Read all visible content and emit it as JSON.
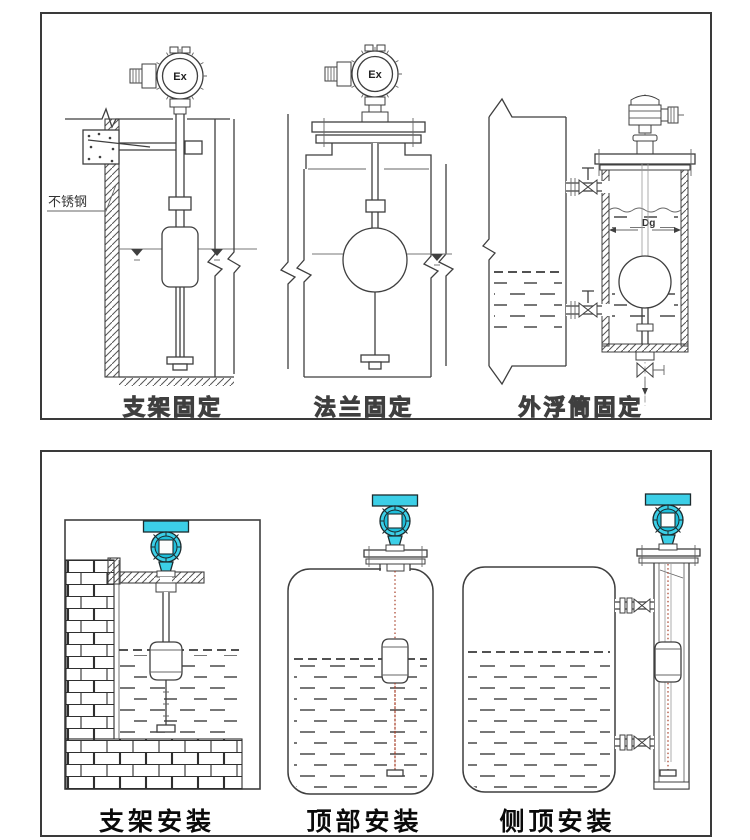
{
  "sheet": {
    "description_labels_visible_only": true
  },
  "panels": {
    "top": {
      "labels": [
        "支架固定",
        "法兰固定",
        "外浮筒固定"
      ],
      "ex_label": "Ex",
      "stainless_steel_note": "不锈钢",
      "diameter_label": "Dg"
    },
    "bottom": {
      "labels": [
        "支架安装",
        "顶部安装",
        "侧顶安装"
      ]
    }
  },
  "colors": {
    "line": "#3f3f3f",
    "transmitter_head_cyan": "#3ccfe7",
    "transmitter_head_cyan_dark": "#1fbeda",
    "rod_centerline_red": "#a63c25",
    "top_label_outline": "#4a4a4a",
    "bottom_label_black": "#0a0a0a",
    "background": "#ffffff"
  }
}
